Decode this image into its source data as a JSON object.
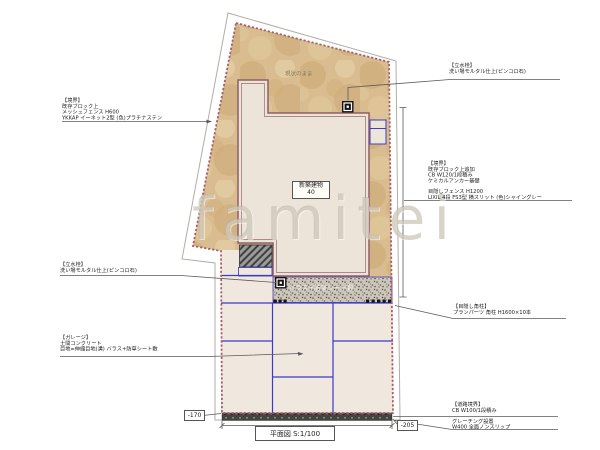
{
  "plan_title": "平面図 S:1/100",
  "watermark": "famitei",
  "site_note": "現状のまま",
  "building_label": {
    "line1": "新築建物",
    "line2": "40"
  },
  "gravel_strip_label": "バラス+防草シート敷",
  "levels": {
    "left": "-170",
    "right": "-205"
  },
  "labels": {
    "fence_left": {
      "lines": [
        "【境界】",
        "既存ブロック上",
        "メッシュフェンス H600",
        "YKKAP イーネット2型 (色)プラチナステン"
      ]
    },
    "tap_top": {
      "lines": [
        "【立水栓】",
        "洗い場モルタル仕上(ピンコロ石)"
      ]
    },
    "boundary_right": {
      "lines": [
        "【境界】",
        "既存ブロック上追加",
        "CB W120/1段積み",
        "ケミカルアンカー基礎",
        "",
        "目隠しフェンス H1200",
        "LIXIL 4段 FS3型 横スリット (色)シャイングレー"
      ]
    },
    "posts_right": {
      "lines": [
        "【目隠し角柱】",
        "プランパーツ 角柱 H1600×10本"
      ]
    },
    "tap_left": {
      "lines": [
        "【立水栓】",
        "洗い場モルタル仕上(ピンコロ石)"
      ]
    },
    "garage": {
      "lines": [
        "【ガレージ】",
        "土間コンクリート",
        "目地=伸縮目地(溝) バラス+防草シート敷"
      ]
    },
    "road": {
      "lines": [
        "【道路境界】",
        "CB W100/1段積み",
        "",
        "グレーチング設置",
        "W400 全面ノンスリップ"
      ]
    }
  },
  "icons": {
    "water_tap_icon": "▣ (black square tap symbol, appears twice)"
  },
  "colors": {
    "boundary_dash": "#a85f68",
    "building_wall": "#8f5f66",
    "joint_blue": "#3a3ac8",
    "gravel_tan": "#d9bc8f",
    "concrete_cream": "#f0e8de",
    "stipple_gray": "#cdc6ba",
    "grating_dark": "#454441",
    "watermark_gray": "#bab09e"
  }
}
